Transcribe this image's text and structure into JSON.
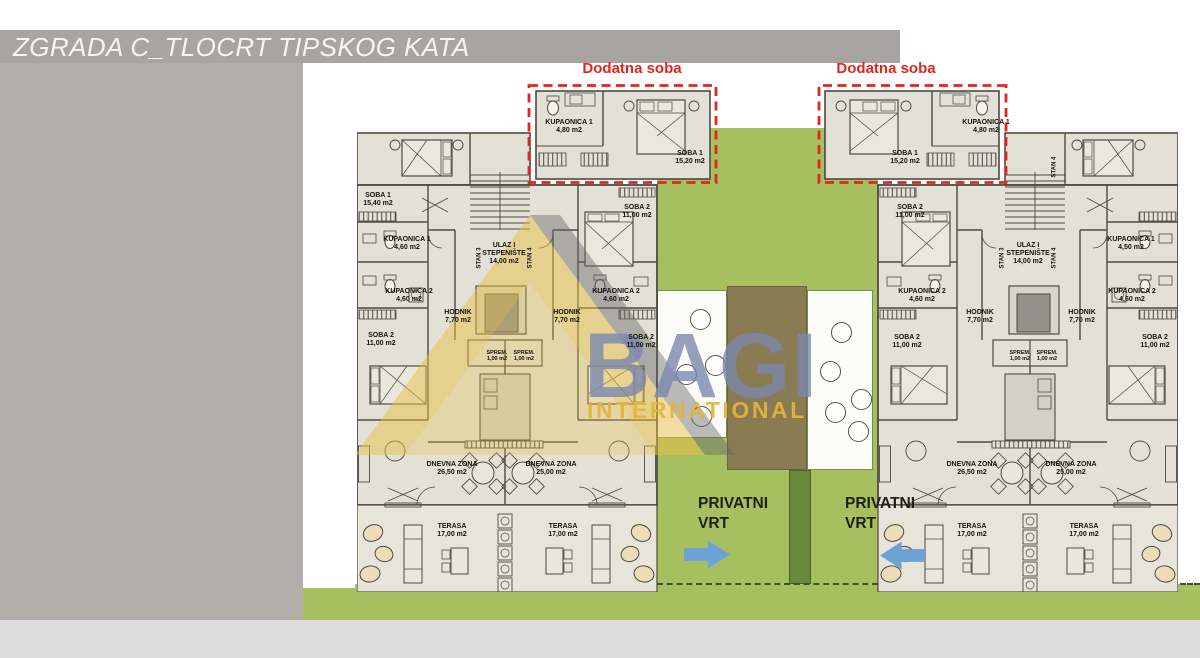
{
  "window": {
    "title": "ZGRADA C_TLOCRT TIPSKOG KATA"
  },
  "callouts": {
    "dodatna_left": "Dodatna soba",
    "dodatna_right": "Dodatna soba",
    "privatni_left": {
      "line1": "PRIVATNI",
      "line2": "VRT"
    },
    "privatni_right": {
      "line1": "PRIVATNI",
      "line2": "VRT"
    }
  },
  "watermark": {
    "brand": "BAGI",
    "tagline": "INTERNATIONAL"
  },
  "colors": {
    "title_bar": "#a8a5a1",
    "side_panel": "#b2afab",
    "bottom_strip": "#dcdcdc",
    "plan_fill": "#e3e0d5",
    "wall": "#4c4a43",
    "garden": "#a6bf5f",
    "garden_dark": "#69883c",
    "path_brown": "#8a7c52",
    "red_accent": "#e1251f",
    "arrow_blue": "#6ba3d6",
    "watermark_blue": "rgba(122,135,174,0.8)",
    "watermark_yellow": "rgba(226,180,60,0.92)"
  },
  "room_labels": [
    {
      "n": "label-soba1-left",
      "t": [
        "SOBA 1",
        "15,40 m2"
      ],
      "x": 378,
      "y": 192
    },
    {
      "n": "label-kupaonica1-left",
      "t": [
        "KUPAONICA 1",
        "4,60 m2"
      ],
      "x": 407,
      "y": 236
    },
    {
      "n": "label-kupaonica2-left",
      "t": [
        "KUPAONICA 2",
        "4,60 m2"
      ],
      "x": 409,
      "y": 288
    },
    {
      "n": "label-soba2-left-a",
      "t": [
        "SOBA 2",
        "11,00 m2"
      ],
      "x": 381,
      "y": 332
    },
    {
      "n": "label-hodnik-left-a",
      "t": [
        "HODNIK",
        "7,70 m2"
      ],
      "x": 458,
      "y": 309
    },
    {
      "n": "label-ulaz-left",
      "t": [
        "ULAZ I",
        "STEPENIŠTE",
        "14,00 m2"
      ],
      "x": 504,
      "y": 242
    },
    {
      "n": "label-stan3-left",
      "t": [
        "STAN 3"
      ],
      "x": 480,
      "y": 258,
      "v": true,
      "s": 6
    },
    {
      "n": "label-stan4-left",
      "t": [
        "STAN 4"
      ],
      "x": 531,
      "y": 258,
      "v": true,
      "s": 6
    },
    {
      "n": "label-soba2-left-b",
      "t": [
        "SOBA 2",
        "11,00 m2"
      ],
      "x": 637,
      "y": 204
    },
    {
      "n": "label-kupaonica2-left-b",
      "t": [
        "KUPAONICA 2",
        "4,60 m2"
      ],
      "x": 616,
      "y": 288
    },
    {
      "n": "label-hodnik-left-b",
      "t": [
        "HODNIK",
        "7,70 m2"
      ],
      "x": 567,
      "y": 309
    },
    {
      "n": "label-soba2-left-c",
      "t": [
        "SOBA 2",
        "11,00 m2"
      ],
      "x": 641,
      "y": 334
    },
    {
      "n": "label-sprem-left-a",
      "t": [
        "SPREM.",
        "1,00 m2"
      ],
      "x": 497,
      "y": 350,
      "s": 5.5
    },
    {
      "n": "label-sprem-left-b",
      "t": [
        "SPREM.",
        "1,00 m2"
      ],
      "x": 524,
      "y": 350,
      "s": 5.5
    },
    {
      "n": "label-dnevna-left-a",
      "t": [
        "DNEVNA ZONA",
        "26,50 m2"
      ],
      "x": 452,
      "y": 461
    },
    {
      "n": "label-dnevna-left-b",
      "t": [
        "DNEVNA ZONA",
        "25,00 m2"
      ],
      "x": 551,
      "y": 461
    },
    {
      "n": "label-terasa-left-a",
      "t": [
        "TERASA",
        "17,00 m2"
      ],
      "x": 452,
      "y": 523
    },
    {
      "n": "label-terasa-left-b",
      "t": [
        "TERASA",
        "17,00 m2"
      ],
      "x": 563,
      "y": 523
    },
    {
      "n": "label-kupaonica1-dodatna-left",
      "t": [
        "KUPAONICA 1",
        "4,80 m2"
      ],
      "x": 569,
      "y": 119
    },
    {
      "n": "label-soba1-dodatna-left",
      "t": [
        "SOBA 1",
        "15,20 m2"
      ],
      "x": 690,
      "y": 150
    },
    {
      "n": "label-soba1-dodatna-right",
      "t": [
        "SOBA 1",
        "15,20 m2"
      ],
      "x": 905,
      "y": 150
    },
    {
      "n": "label-kupaonica1-dodatna-right",
      "t": [
        "KUPAONICA 1",
        "4,80 m2"
      ],
      "x": 986,
      "y": 119
    },
    {
      "n": "label-soba2-right-a",
      "t": [
        "SOBA 2",
        "11,00 m2"
      ],
      "x": 910,
      "y": 204
    },
    {
      "n": "label-kupaonica2-right-a",
      "t": [
        "KUPAONICA 2",
        "4,60 m2"
      ],
      "x": 922,
      "y": 288
    },
    {
      "n": "label-soba2-right-b",
      "t": [
        "SOBA 2",
        "11,00 m2"
      ],
      "x": 907,
      "y": 334
    },
    {
      "n": "label-hodnik-right-a",
      "t": [
        "HODNIK",
        "7,70 m2"
      ],
      "x": 980,
      "y": 309
    },
    {
      "n": "label-ulaz-right",
      "t": [
        "ULAZ I",
        "STEPENIŠTE",
        "14,00 m2"
      ],
      "x": 1028,
      "y": 242
    },
    {
      "n": "label-stan3-right",
      "t": [
        "STAN 3"
      ],
      "x": 1003,
      "y": 258,
      "v": true,
      "s": 6
    },
    {
      "n": "label-stan4-right",
      "t": [
        "STAN 4"
      ],
      "x": 1055,
      "y": 258,
      "v": true,
      "s": 6
    },
    {
      "n": "label-stan4-right-top",
      "t": [
        "STAN 4"
      ],
      "x": 1055,
      "y": 167,
      "v": true,
      "s": 6
    },
    {
      "n": "label-hodnik-right-b",
      "t": [
        "HODNIK",
        "7,70 m2"
      ],
      "x": 1082,
      "y": 309
    },
    {
      "n": "label-kupaonica1-right",
      "t": [
        "KUPAONICA 1",
        "4,50 m2"
      ],
      "x": 1131,
      "y": 236
    },
    {
      "n": "label-kupaonica2-right-b",
      "t": [
        "KUPAONICA 2",
        "4,60 m2"
      ],
      "x": 1132,
      "y": 288
    },
    {
      "n": "label-soba2-right-c",
      "t": [
        "SOBA 2",
        "11,00 m2"
      ],
      "x": 1155,
      "y": 334
    },
    {
      "n": "label-sprem-right-a",
      "t": [
        "SPREM.",
        "1,00 m2"
      ],
      "x": 1020,
      "y": 350,
      "s": 5.5
    },
    {
      "n": "label-sprem-right-b",
      "t": [
        "SPREM.",
        "1,00 m2"
      ],
      "x": 1047,
      "y": 350,
      "s": 5.5
    },
    {
      "n": "label-dnevna-right-a",
      "t": [
        "DNEVNA ZONA",
        "26,50 m2"
      ],
      "x": 972,
      "y": 461
    },
    {
      "n": "label-dnevna-right-b",
      "t": [
        "DNEVNA ZONA",
        "25,00 m2"
      ],
      "x": 1071,
      "y": 461
    },
    {
      "n": "label-terasa-right-a",
      "t": [
        "TERASA",
        "17,00 m2"
      ],
      "x": 972,
      "y": 523
    },
    {
      "n": "label-terasa-right-b",
      "t": [
        "TERASA",
        "17,00 m2"
      ],
      "x": 1084,
      "y": 523
    }
  ]
}
